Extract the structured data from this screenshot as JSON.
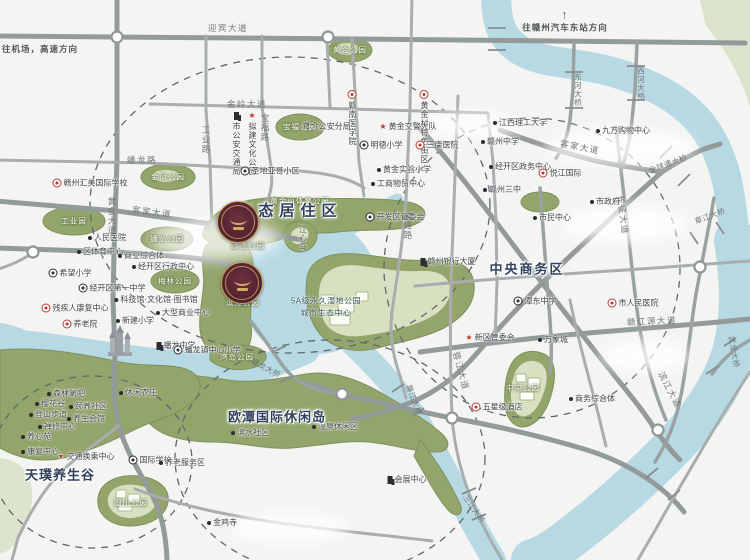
{
  "map": {
    "colors": {
      "background": "#f4f5f2",
      "water": "#b7d9e4",
      "green": "#93a56b",
      "pale_green": "#d9e2c4",
      "road": "#9aa1a1",
      "zone_text": "#31415e",
      "badge_bg": "#57252f",
      "badge_gold": "#d4ab66",
      "marker_red": "#b93a34"
    },
    "zones": [
      {
        "x": 290,
        "y": 210,
        "t": "生态居住区",
        "s": 15,
        "sp": 6
      },
      {
        "x": 527,
        "y": 268,
        "t": "中央商务区",
        "s": 13,
        "sp": 2
      },
      {
        "x": 277,
        "y": 416,
        "t": "欧潭国际休闲岛",
        "s": 13,
        "sp": 1
      },
      {
        "x": 60,
        "y": 474,
        "t": "天璞养生谷",
        "s": 13,
        "sp": 1
      }
    ],
    "directions": [
      {
        "x": 40,
        "y": 49,
        "t": "往机场，高速方向",
        "arrow": ""
      },
      {
        "x": 565,
        "y": 21,
        "t": "往赣州汽车东站方向",
        "arrow": "↑"
      }
    ],
    "roads": [
      {
        "x": 228,
        "y": 28,
        "t": "迎宾大道",
        "r": 0
      },
      {
        "x": 247,
        "y": 104,
        "t": "金岭大道",
        "r": 0
      },
      {
        "x": 206,
        "y": 140,
        "t": "工业路",
        "r": 90
      },
      {
        "x": 142,
        "y": 160,
        "t": "蟠龙路",
        "r": 0
      },
      {
        "x": 265,
        "y": 128,
        "t": "宝福路",
        "r": 90
      },
      {
        "x": 112,
        "y": 216,
        "t": "黄金大道",
        "r": 90
      },
      {
        "x": 152,
        "y": 212,
        "t": "客家大道",
        "r": 7
      },
      {
        "x": 580,
        "y": 147,
        "t": "客家大道",
        "r": 11
      },
      {
        "x": 623,
        "y": 215,
        "t": "长征大道",
        "r": 83
      },
      {
        "x": 652,
        "y": 321,
        "t": "赣江源大道",
        "r": -3
      },
      {
        "x": 408,
        "y": 226,
        "t": "文峰路",
        "r": 90
      },
      {
        "x": 461,
        "y": 371,
        "t": "蓉江大道",
        "r": 75
      },
      {
        "x": 670,
        "y": 390,
        "t": "滨江大道",
        "r": 62
      }
    ],
    "bridges": [
      {
        "x": 578,
        "y": 90,
        "t": "东河大桥",
        "r": 90
      },
      {
        "x": 641,
        "y": 84,
        "t": "西河大桥",
        "r": 90
      },
      {
        "x": 668,
        "y": 164,
        "t": "全球通大桥",
        "r": -20
      },
      {
        "x": 710,
        "y": 216,
        "t": "章江大桥",
        "r": -20
      },
      {
        "x": 734,
        "y": 352,
        "t": "武龙大桥",
        "r": 80
      },
      {
        "x": 266,
        "y": 368,
        "t": "蟠龙大桥",
        "r": 28
      },
      {
        "x": 414,
        "y": 400,
        "t": "蓉江大桥",
        "r": 68
      },
      {
        "x": 474,
        "y": 509,
        "t": "三江大桥",
        "r": 55
      }
    ],
    "parks": [
      {
        "x": 350,
        "y": 50,
        "t": "黄金公园"
      },
      {
        "x": 300,
        "y": 127,
        "t": "宝福公园"
      },
      {
        "x": 168,
        "y": 177,
        "t": "金凤公园"
      },
      {
        "x": 74,
        "y": 221,
        "t": "工业园"
      },
      {
        "x": 167,
        "y": 239,
        "t": "蟠龙公园"
      },
      {
        "x": 175,
        "y": 281,
        "t": "梅林公园"
      },
      {
        "x": 248,
        "y": 246,
        "t": "欧潭公园"
      },
      {
        "x": 243,
        "y": 303,
        "t": "滨潭公园"
      },
      {
        "x": 237,
        "y": 357,
        "t": "湾岛公园"
      },
      {
        "x": 300,
        "y": 201,
        "t": "黄金山体育公园"
      },
      {
        "x": 523,
        "y": 388,
        "t": "中央公园"
      },
      {
        "x": 131,
        "y": 503,
        "t": "圆山公园"
      }
    ],
    "pois": [
      {
        "x": 236,
        "y": 112,
        "i": "bld",
        "t": "市公安交通局",
        "v": 1
      },
      {
        "x": 252,
        "y": 112,
        "i": "star",
        "t": "拟建文化公园",
        "v": 1
      },
      {
        "x": 270,
        "y": 171,
        "i": "gear",
        "t": "圣地亚哥小区"
      },
      {
        "x": 90,
        "y": 183,
        "i": "ring",
        "t": "赣州汇美国际学校"
      },
      {
        "x": 352,
        "y": 90,
        "i": "ring",
        "t": "赣南医学院",
        "v": 1
      },
      {
        "x": 424,
        "y": 90,
        "i": "ring",
        "t": "黄金村特色街区",
        "v": 1
      },
      {
        "x": 322,
        "y": 127,
        "i": "star",
        "t": "黄金公安分局"
      },
      {
        "x": 408,
        "y": 127,
        "i": "star",
        "t": "黄金交警大队"
      },
      {
        "x": 381,
        "y": 145,
        "i": "gear",
        "t": "明德小学"
      },
      {
        "x": 437,
        "y": 145,
        "i": "ring",
        "t": "三康医院"
      },
      {
        "x": 500,
        "y": 142,
        "i": "dot",
        "t": "赣州中学"
      },
      {
        "x": 404,
        "y": 170,
        "i": "dot",
        "t": "黄金实验小学"
      },
      {
        "x": 398,
        "y": 184,
        "i": "dot",
        "t": "工商物贸中心"
      },
      {
        "x": 520,
        "y": 167,
        "i": "dot",
        "t": "经开区政务中心"
      },
      {
        "x": 107,
        "y": 238,
        "i": "dot",
        "t": "人民医院"
      },
      {
        "x": 100,
        "y": 252,
        "i": "dot",
        "t": "区体育中心"
      },
      {
        "x": 141,
        "y": 256,
        "i": "dot",
        "t": "商业综合体"
      },
      {
        "x": 163,
        "y": 267,
        "i": "dot",
        "t": "经开区行政中心"
      },
      {
        "x": 70,
        "y": 273,
        "i": "gear",
        "t": "希望小学"
      },
      {
        "x": 112,
        "y": 288,
        "i": "gear",
        "t": "经开区第一中学"
      },
      {
        "x": 75,
        "y": 308,
        "i": "redring",
        "t": "残疾人康复中心"
      },
      {
        "x": 80,
        "y": 324,
        "i": "redring",
        "t": "养老院"
      },
      {
        "x": 156,
        "y": 300,
        "i": "dot",
        "t": "科技馆·文化馆·图书馆"
      },
      {
        "x": 183,
        "y": 313,
        "i": "dot",
        "t": "大型商业中心"
      },
      {
        "x": 135,
        "y": 321,
        "i": "dot",
        "t": "新建小学"
      },
      {
        "x": 176,
        "y": 346,
        "i": "bld",
        "t": "蟠龙中学"
      },
      {
        "x": 207,
        "y": 350,
        "i": "gear",
        "t": "蟠龙镇中心小学"
      },
      {
        "x": 395,
        "y": 217,
        "i": "gear",
        "t": "开发区管委会"
      },
      {
        "x": 520,
        "y": 123,
        "i": "dot",
        "t": "江西理工大学"
      },
      {
        "x": 623,
        "y": 131,
        "i": "dot",
        "t": "九方购物中心"
      },
      {
        "x": 560,
        "y": 173,
        "i": "ring",
        "t": "悦江国际"
      },
      {
        "x": 502,
        "y": 190,
        "i": "dot",
        "t": "赣州三中"
      },
      {
        "x": 605,
        "y": 202,
        "i": "dot",
        "t": "市政府"
      },
      {
        "x": 552,
        "y": 218,
        "i": "dot",
        "t": "市民中心"
      },
      {
        "x": 448,
        "y": 262,
        "i": "bld",
        "t": "赣州银行大厦"
      },
      {
        "x": 535,
        "y": 301,
        "i": "gear",
        "t": "潭东中学"
      },
      {
        "x": 633,
        "y": 303,
        "i": "ring",
        "t": "市人民医院"
      },
      {
        "x": 490,
        "y": 338,
        "i": "star",
        "t": "新区管委会"
      },
      {
        "x": 553,
        "y": 340,
        "i": "dot",
        "t": "万象城"
      },
      {
        "x": 497,
        "y": 407,
        "i": "redring",
        "t": "五星级酒店"
      },
      {
        "x": 592,
        "y": 399,
        "i": "dot",
        "t": "商务综合体"
      },
      {
        "x": 407,
        "y": 480,
        "i": "bld",
        "t": "会展中心"
      },
      {
        "x": 66,
        "y": 394,
        "i": "dot",
        "t": "森林氧吧"
      },
      {
        "x": 50,
        "y": 404,
        "i": "dot",
        "t": "樱花谷"
      },
      {
        "x": 88,
        "y": 407,
        "i": "dot",
        "t": "颐养社区"
      },
      {
        "x": 48,
        "y": 415,
        "i": "dot",
        "t": "登山步道"
      },
      {
        "x": 86,
        "y": 419,
        "i": "dot",
        "t": "养生会馆"
      },
      {
        "x": 57,
        "y": 427,
        "i": "dot",
        "t": "禅修中心"
      },
      {
        "x": 36,
        "y": 437,
        "i": "dot",
        "t": "养心苑"
      },
      {
        "x": 40,
        "y": 452,
        "i": "dot",
        "t": "康复中心"
      },
      {
        "x": 86,
        "y": 457,
        "i": "redtri",
        "t": "交通换乘中心"
      },
      {
        "x": 138,
        "y": 393,
        "i": "dot",
        "t": "休闲农庄"
      },
      {
        "x": 150,
        "y": 460,
        "i": "gear",
        "t": "国际学校"
      },
      {
        "x": 182,
        "y": 463,
        "i": "dot",
        "t": "养老服务区"
      },
      {
        "x": 250,
        "y": 433,
        "i": "dot",
        "t": "滨水社区"
      },
      {
        "x": 335,
        "y": 427,
        "i": "dot",
        "t": "温泉休闲区"
      },
      {
        "x": 222,
        "y": 523,
        "i": "dot",
        "t": "金鸡寺"
      }
    ],
    "labels_misc": [
      {
        "x": 303,
        "y": 238,
        "t": "江心岛",
        "island": 1
      },
      {
        "x": 326,
        "y": 301,
        "t": "5A级永久湿地公园"
      },
      {
        "x": 326,
        "y": 313,
        "t": "城市生态中心"
      }
    ],
    "badges": [
      {
        "x": 238,
        "y": 222
      },
      {
        "x": 242,
        "y": 283
      }
    ]
  }
}
